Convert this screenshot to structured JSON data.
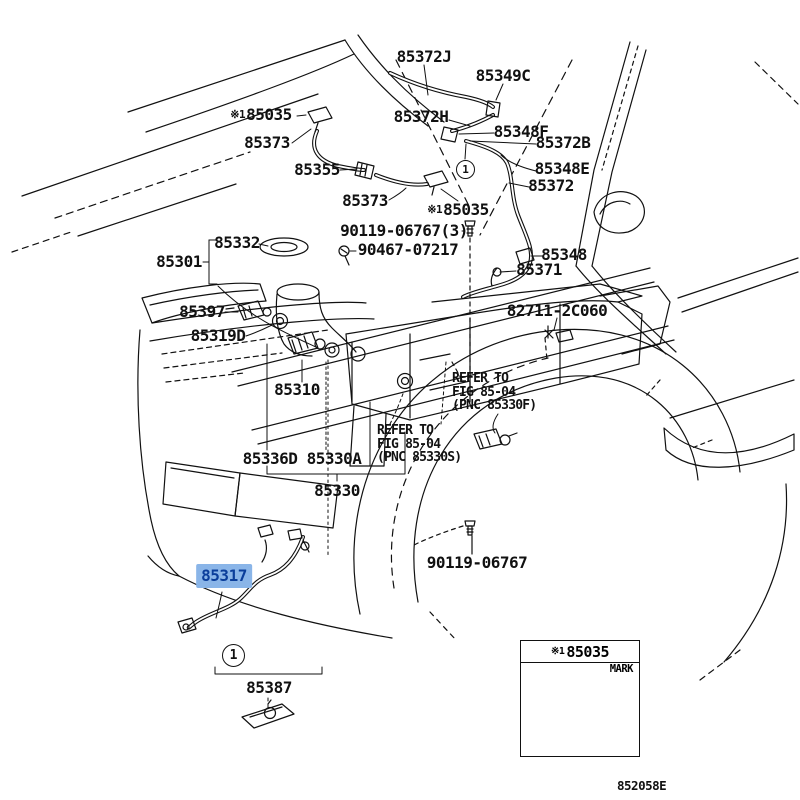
{
  "title": "Toyota windshield washer parts diagram",
  "colors": {
    "line": "#111111",
    "highlight_bg": "#8ab5e8",
    "highlight_text": "#0b3e9b"
  },
  "callouts": {
    "number": "1"
  },
  "labels": [
    {
      "text": "85372J"
    },
    {
      "text": "85349C"
    },
    {
      "prefix": "※1",
      "text": "85035"
    },
    {
      "text": "85372H"
    },
    {
      "text": "85348F"
    },
    {
      "text": "85373"
    },
    {
      "text": "85372B"
    },
    {
      "text": "85355"
    },
    {
      "text": "85348E"
    },
    {
      "text": "85372"
    },
    {
      "text": "85373"
    },
    {
      "prefix": "※1",
      "text": "85035"
    },
    {
      "text": "90119-06767(3)"
    },
    {
      "text": "85332"
    },
    {
      "text": "90467-07217"
    },
    {
      "text": "85301"
    },
    {
      "text": "85348"
    },
    {
      "text": "85371"
    },
    {
      "text": "85397"
    },
    {
      "text": "82711-2C060"
    },
    {
      "text": "85319D"
    },
    {
      "text": "85310"
    },
    {
      "text": "REFER TO\nFIG 85-04\n(PNC 85330F)"
    },
    {
      "text": "REFER TO\nFIG 85-04\n(PNC 85330S)"
    },
    {
      "text": "85336D 85330A"
    },
    {
      "text": "85330"
    },
    {
      "text": "85317",
      "highlighted": true
    },
    {
      "text": "90119-06767"
    },
    {
      "text": "85387"
    }
  ],
  "inset": {
    "prefix": "※1",
    "part": "85035",
    "mark": "MARK"
  },
  "footer": {
    "code": "852058E"
  }
}
